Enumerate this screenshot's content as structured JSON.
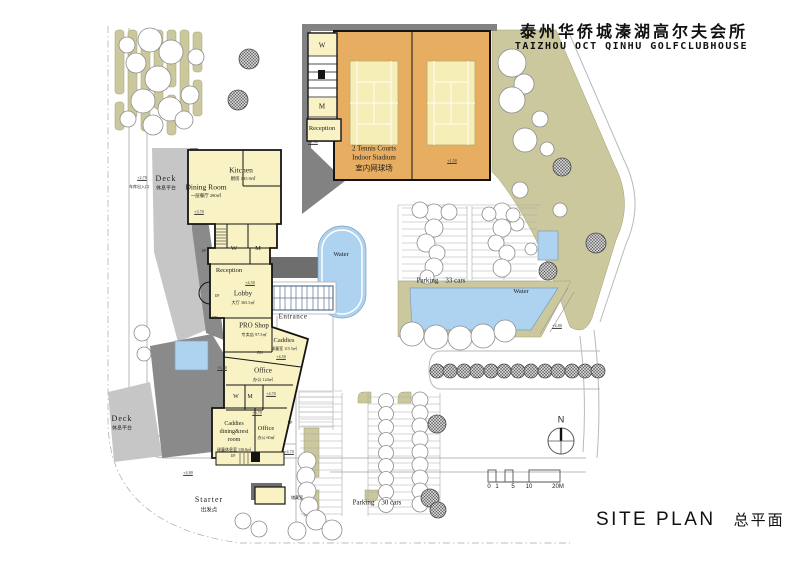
{
  "header": {
    "title_cn": "泰州华侨城溱湖高尔夫会所",
    "title_en": "TAIZHOU OCT QINHU GOLFCLUBHOUSE"
  },
  "titleblock": {
    "site_plan_en": "SITE PLAN",
    "site_plan_cn": "总平面",
    "north": "N"
  },
  "scalebar": {
    "t0": "0",
    "t1": "1",
    "t2": "5",
    "t3": "10",
    "t4": "20M"
  },
  "tennis": {
    "w": "W",
    "m": "M",
    "reception": "Reception",
    "name_line1": "2 Tennis Courts",
    "name_line2": "Indoor Stadium",
    "name_line3": "室内网球场"
  },
  "clubhouse": {
    "kitchen": "Kitchen",
    "kitchen_area": "厨房 135.9㎡",
    "dining": "Dining Room",
    "dining_area": "一层餐厅 280㎡",
    "w": "W",
    "m": "M",
    "reception": "Reception",
    "lobby": "Lobby",
    "lobby_area": "大厅 365.5㎡",
    "proshop": "PRO Shop",
    "proshop_area": "专卖店 97.5㎡",
    "caddies": "Caddies",
    "caddies_area": "球童室 115.5㎡",
    "office1": "Office",
    "office1_area": "办公 124㎡",
    "office2": "Office",
    "office2_area": "办公 60㎡",
    "caddies_room_l1": "Caddies",
    "caddies_room_l2": "dining&rest",
    "caddies_room_l3": "room",
    "caddies_room_area": "球童休息室 138.8㎡",
    "up": "UP",
    "dn": "DN"
  },
  "site": {
    "deck": "Deck",
    "deck_cn": "休息平台",
    "starter": "Starter",
    "starter_cn": "出发点",
    "hut": "储藏室",
    "garage": "车库出入口",
    "entrance": "Entrance",
    "water": "Water",
    "parking33": "Parking    33 cars",
    "parking30": "Parking    30 cars"
  },
  "elevations": {
    "e150": "+1.50",
    "e270": "+2.70",
    "e370": "+3.70",
    "e450": "+4.50",
    "e470": "+4.70",
    "e480": "+4.80",
    "e570": "+5.70"
  }
}
